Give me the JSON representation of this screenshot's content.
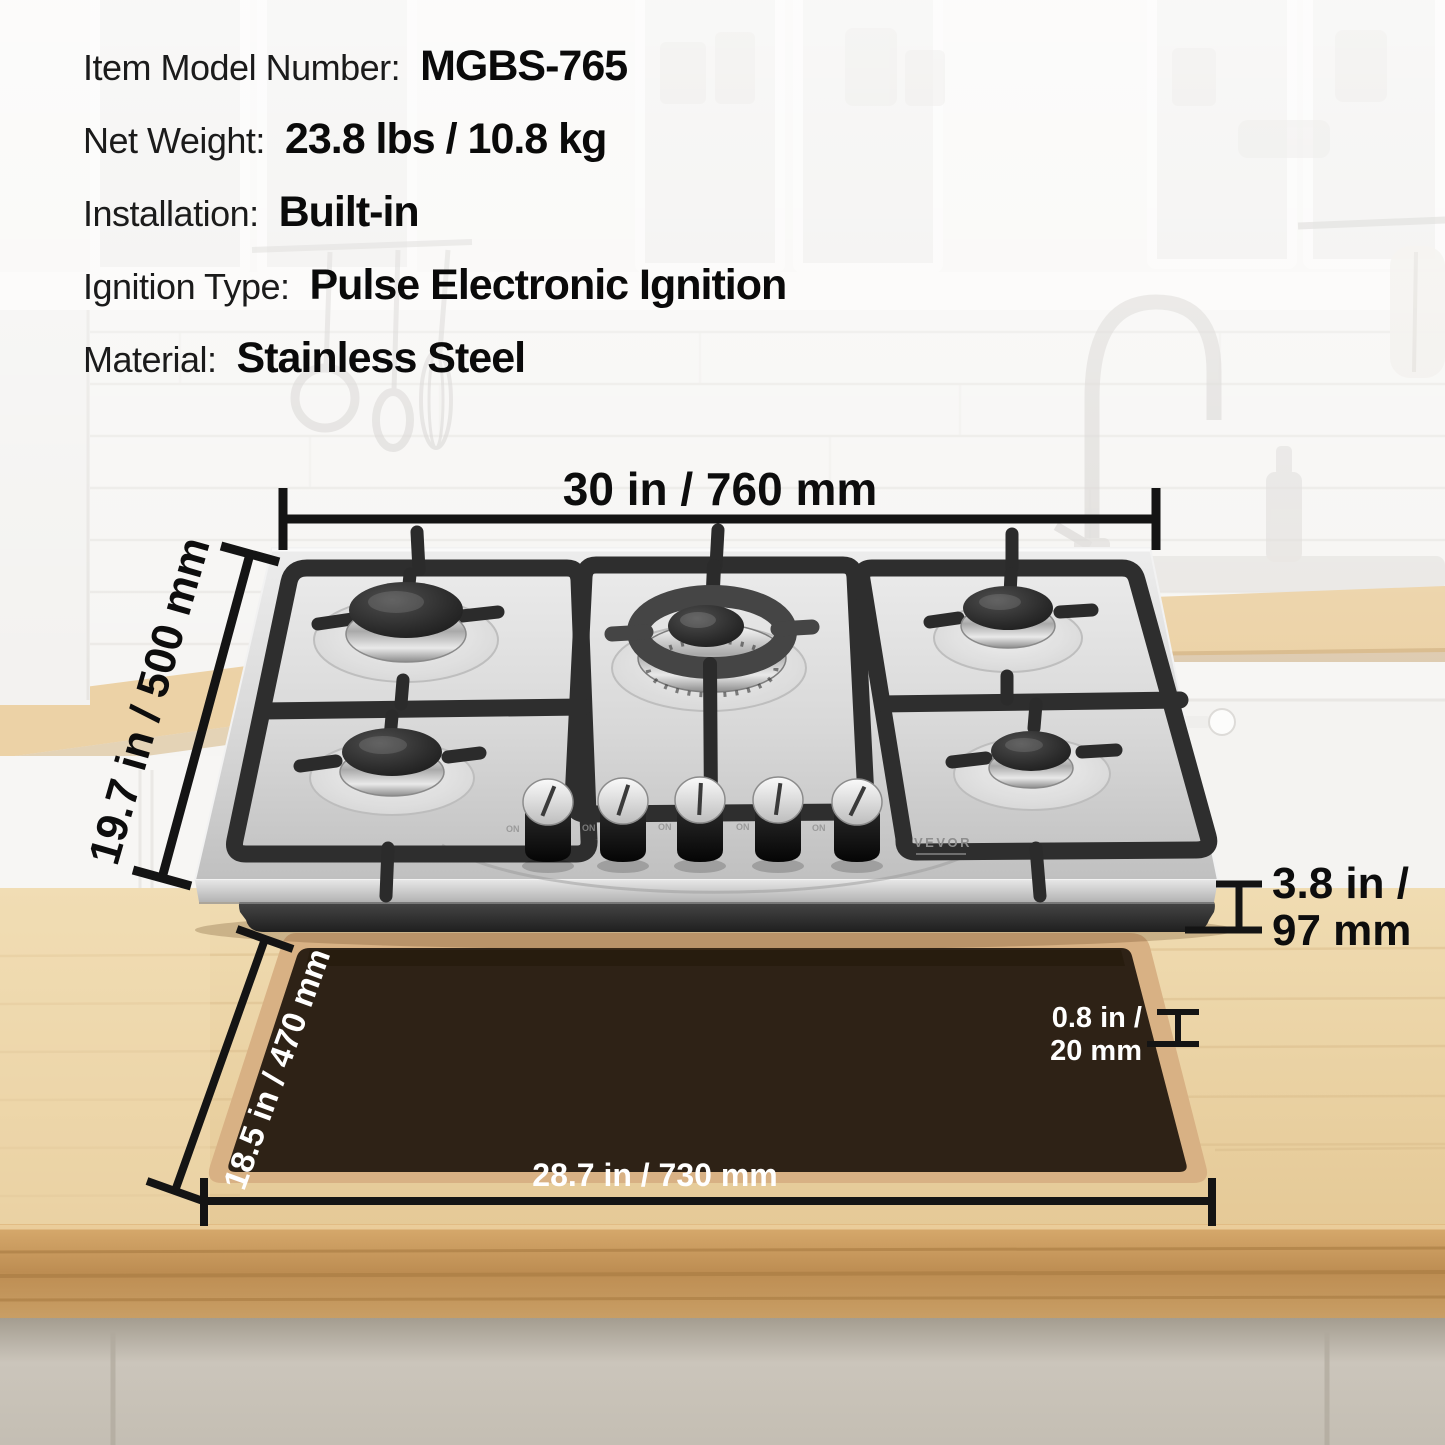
{
  "specs": {
    "items": [
      {
        "label": "Item Model Number:",
        "value": "MGBS-765"
      },
      {
        "label": "Net Weight:",
        "value": "23.8 lbs / 10.8 kg"
      },
      {
        "label": "Installation:",
        "value": "Built-in"
      },
      {
        "label": "Ignition Type:",
        "value": "Pulse Electronic Ignition"
      },
      {
        "label": "Material:",
        "value": "Stainless Steel"
      }
    ]
  },
  "dimensions": {
    "width_top": "30 in / 760 mm",
    "depth_left": "19.7 in / 500 mm",
    "height_right_line1": "3.8 in /",
    "height_right_line2": "97 mm",
    "counter_thickness_line1": "0.8 in /",
    "counter_thickness_line2": "20 mm",
    "cutout_depth": "18.5 in / 470 mm",
    "cutout_width": "28.7 in / 730 mm"
  },
  "cooktop": {
    "brand": "VEVOR",
    "knob_mark": "ON"
  },
  "colors": {
    "annotation_black": "#111111",
    "annotation_white": "#ffffff",
    "cutout_brown": "#2e2216",
    "countertop_wood": "#e9d0a4",
    "stainless": "#d9d9d9"
  }
}
